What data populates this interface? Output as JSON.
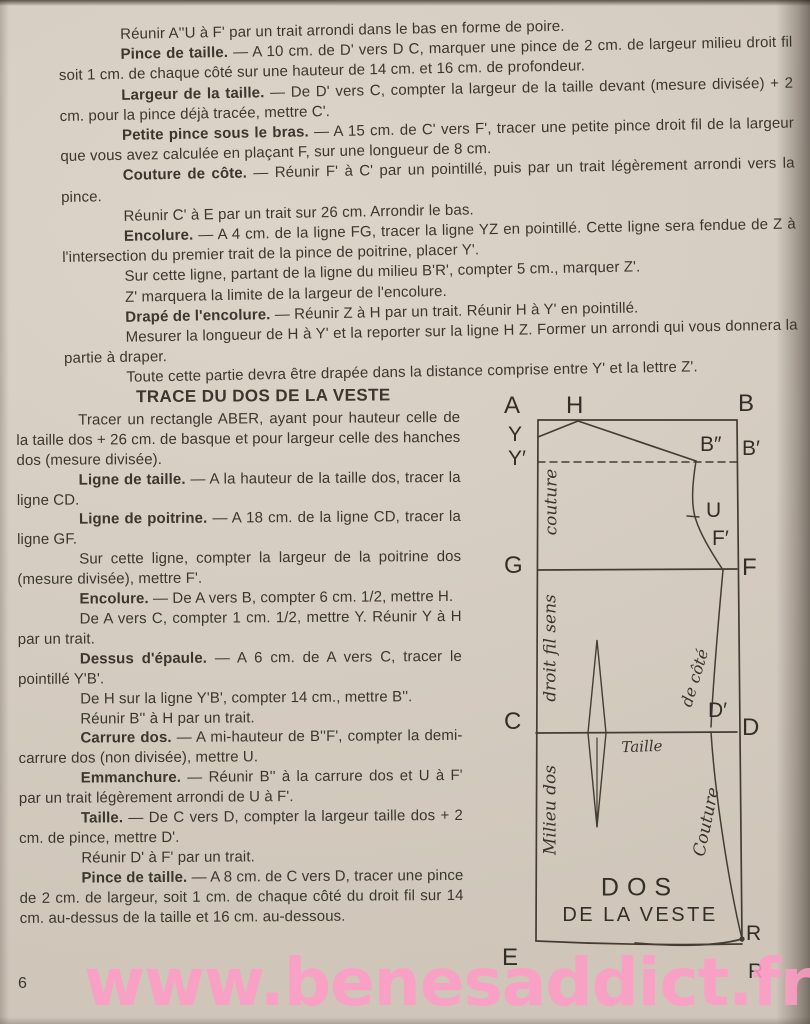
{
  "page": {
    "number": "6",
    "watermark": "www.benesaddict.fr"
  },
  "colors": {
    "paper": "#d8cfc4",
    "ink": "#3b362e",
    "watermark": "#ff9cc6",
    "linecol": "#433d34"
  },
  "intro": [
    {
      "lead": "",
      "text": "Réunir A''U à F' par un trait arrondi dans le bas en forme de poire."
    },
    {
      "lead": "Pince de taille.",
      "text": "— A 10 cm. de D' vers D C, marquer une pince de 2 cm. de largeur milieu droit fil soit 1 cm. de chaque côté sur une hauteur de 14 cm. et 16 cm. de profondeur."
    },
    {
      "lead": "Largeur de la taille.",
      "text": "— De D' vers C, compter la largeur de la taille devant (mesure divisée) + 2 cm. pour la pince déjà tracée, mettre C'."
    },
    {
      "lead": "Petite pince sous le bras.",
      "text": "— A 15 cm. de C' vers F', tracer une petite pince droit fil de la largeur que vous avez calculée en plaçant F, sur une longueur de 8 cm."
    },
    {
      "lead": "Couture de côte.",
      "text": "— Réunir F' à C' par un pointillé, puis par un trait légèrement arrondi vers la pince."
    },
    {
      "lead": "",
      "text": "Réunir C' à E par un trait sur 26 cm. Arrondir le bas."
    },
    {
      "lead": "Encolure.",
      "text": "— A 4 cm. de la ligne FG, tracer la ligne YZ en pointillé. Cette ligne sera fendue de Z à l'intersection du premier trait de la pince de poitrine, placer Y'."
    },
    {
      "lead": "",
      "text": "Sur cette ligne, partant de la ligne du milieu B'R', compter 5 cm., marquer Z'."
    },
    {
      "lead": "",
      "text": "Z' marquera la limite de la largeur de l'encolure."
    },
    {
      "lead": "Drapé de l'encolure.",
      "text": "— Réunir Z à H par un trait. Réunir H à Y' en pointillé."
    },
    {
      "lead": "",
      "text": "Mesurer la longueur de H à Y' et la reporter sur la ligne H Z. Former un arrondi qui vous donnera la partie à draper."
    },
    {
      "lead": "",
      "text": "Toute cette partie devra être drapée dans la distance comprise entre Y' et la lettre Z'."
    }
  ],
  "left": {
    "heading": "TRACE DU DOS DE LA VESTE",
    "paragraphs": [
      {
        "lead": "",
        "text": "Tracer un rectangle ABER, ayant pour hauteur celle de la taille dos + 26 cm. de basque et pour largeur celle des hanches dos (mesure divisée)."
      },
      {
        "lead": "Ligne de taille.",
        "text": "— A la hauteur de la taille dos, tracer la ligne CD."
      },
      {
        "lead": "Ligne de poitrine.",
        "text": "— A 18 cm. de la ligne CD, tracer la ligne GF."
      },
      {
        "lead": "",
        "text": "Sur cette ligne, compter la largeur de la poitrine dos (mesure divisée), mettre F'."
      },
      {
        "lead": "Encolure.",
        "text": "— De A vers B, compter 6 cm. 1/2, mettre H."
      },
      {
        "lead": "",
        "text": "De A vers C, compter 1 cm. 1/2, mettre Y. Réunir Y à H par un trait."
      },
      {
        "lead": "Dessus d'épaule.",
        "text": "— A 6 cm. de A vers C, tracer le pointillé Y'B'."
      },
      {
        "lead": "",
        "text": "De H sur la ligne Y'B', compter 14 cm., mettre B''."
      },
      {
        "lead": "",
        "text": "Réunir B'' à H par un trait."
      },
      {
        "lead": "Carrure dos.",
        "text": "— A mi-hauteur de B''F', compter la demi-carrure dos (non divisée), mettre U."
      },
      {
        "lead": "Emmanchure.",
        "text": "— Réunir B'' à la carrure dos et U à F' par un trait légèrement arrondi de U à F'."
      },
      {
        "lead": "Taille.",
        "text": "— De C vers D, compter la largeur taille dos + 2 cm. de pince, mettre D'."
      },
      {
        "lead": "",
        "text": "Réunir D' à F' par un trait."
      },
      {
        "lead": "Pince de taille.",
        "text": "— A 8 cm. de C vers D, tracer une pince de 2 cm. de largeur, soit 1 cm. de chaque côté du droit fil sur 14 cm. au-dessus de la taille et 16 cm. au-dessous."
      }
    ]
  },
  "diagram": {
    "labels": {
      "a": "A",
      "h": "H",
      "b": "B",
      "y": "Y",
      "y_prime": "Y′",
      "b_dbl": "B″",
      "b_prime": "B′",
      "g": "G",
      "u": "U",
      "f_prime": "F′",
      "f": "F",
      "c": "C",
      "d_prime": "D′",
      "d": "D",
      "e": "E",
      "r_top": "R",
      "r_bottom": "R"
    },
    "annotations": {
      "seam_left": "couture",
      "grain": "droit fil sens",
      "center_back": "Milieu dos",
      "side": "de côté",
      "seam_right": "Couture",
      "waist": "Taille"
    },
    "caption": {
      "line1": "DOS",
      "line2": "DE LA VESTE"
    }
  }
}
